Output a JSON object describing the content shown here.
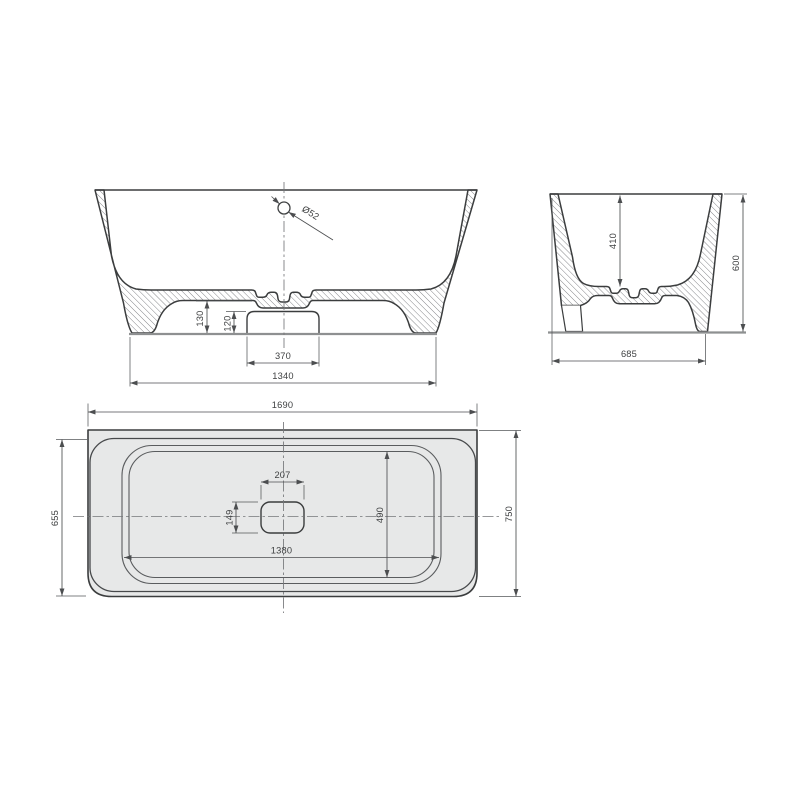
{
  "front_view": {
    "drain_diameter": "Ø52",
    "underfloor_height": "130",
    "plinth_height": "120",
    "plinth_width": "370",
    "base_width": "1340"
  },
  "side_view": {
    "inner_depth": "410",
    "overall_height": "600",
    "overall_depth": "685"
  },
  "plan_view": {
    "overall_length": "1690",
    "body_depth": "655",
    "overall_depth": "750",
    "inner_length": "1380",
    "inner_width": "490",
    "drain_cutout_length": "207",
    "drain_cutout_width": "149"
  },
  "colors": {
    "line": "#3b3d3e",
    "dimension": "#4c4e50",
    "plan_fill": "#e7e8e8",
    "ground": "#8e9091"
  }
}
